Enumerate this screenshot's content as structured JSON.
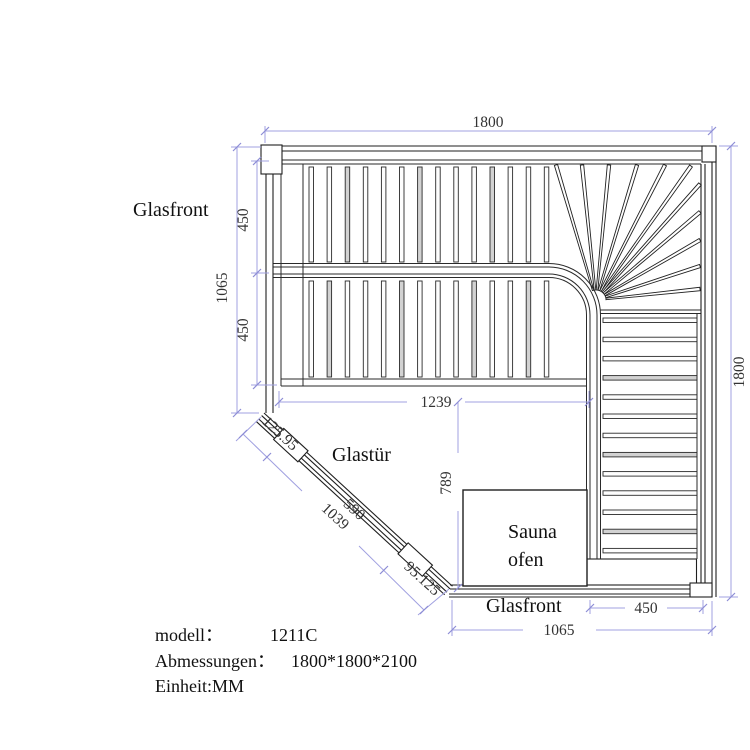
{
  "drawing": {
    "labels": {
      "glasfront_left": "Glasfront",
      "glastuer": "Glastür",
      "sauna_line1": "Sauna",
      "sauna_line2": "ofen",
      "glasfront_bottom": "Glasfront"
    },
    "dimensions": {
      "top_width": "1800",
      "right_height": "1800",
      "left_glass_height": "1065",
      "left_bench_upper": "450",
      "left_bench_lower": "450",
      "bench_width": "1239",
      "floor_depth": "789",
      "diag_seg1": "125.95",
      "diag_door": "590",
      "diag_total": "1039",
      "diag_seg3": "95.125",
      "bottom_bench": "450",
      "bottom_glass": "1065"
    },
    "info": {
      "model_label": "modell：",
      "model_value": "1211C",
      "size_label": "Abmessungen：",
      "size_value": "1800*1800*2100",
      "unit_label": "Einheit:MM"
    },
    "colors": {
      "line": "#1f1f1f",
      "dimension_line": "#a0a0e0",
      "dimension_text": "#333333",
      "label_text": "#111111",
      "background": "#ffffff"
    }
  }
}
